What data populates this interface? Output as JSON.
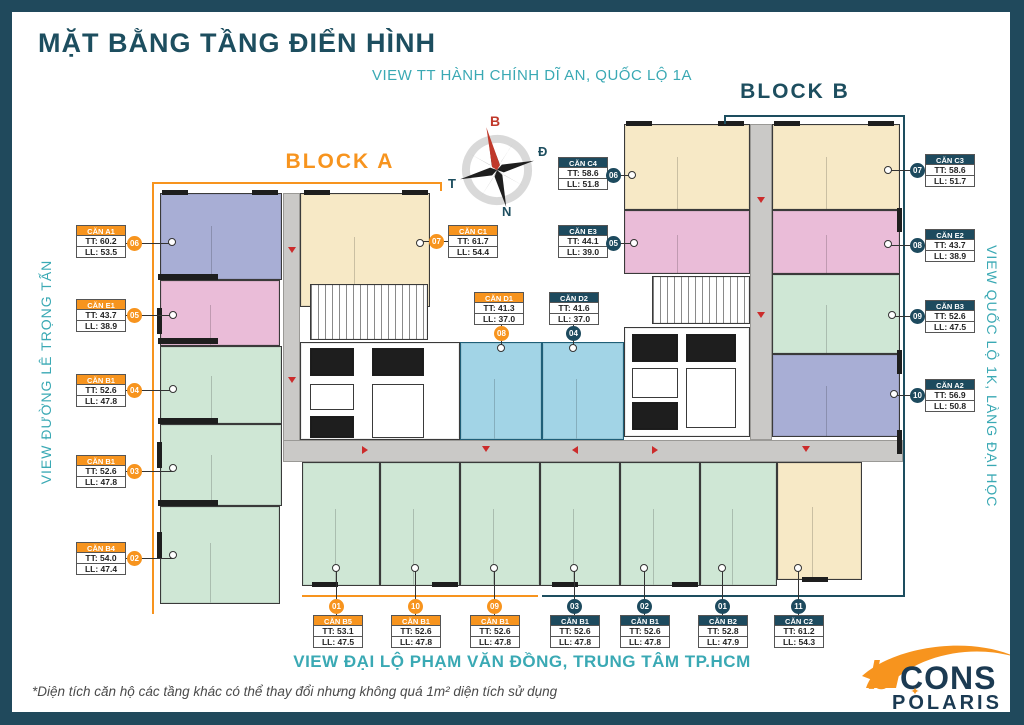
{
  "header": {
    "title": "MẶT BẰNG TẦNG ĐIỂN HÌNH",
    "subtitle": "VIEW TT HÀNH CHÍNH DĨ AN, QUỐC LỘ 1A"
  },
  "views": {
    "left": "VIEW ĐƯỜNG LÊ TRỌNG TẤN",
    "right": "VIEW QUỐC LỘ 1K, LÀNG ĐẠI HỌC",
    "bottom": "VIEW ĐẠI LỘ PHẠM VĂN ĐỒNG, TRUNG TÂM TP.HCM"
  },
  "footnote": "*Diện tích căn hộ các tầng khác có thể thay đổi nhưng không quá 1m² diện tích sử dụng",
  "blocks": {
    "a": "BLOCK A",
    "b": "BLOCK B"
  },
  "compass": {
    "north": "B",
    "east": "Đ",
    "south": "N",
    "west": "T"
  },
  "logo": {
    "b": "b",
    "cons": "CONS",
    "polaris_p": "P",
    "polaris_o": "O",
    "polaris_rest": "LARIS",
    "star": "✦"
  },
  "colors": {
    "frame": "#20495c",
    "navy": "#1d4e5f",
    "teal_text": "#3aa9b4",
    "orange": "#f7941e",
    "badge_teal": "#1d4a5e",
    "cream": "#f7e9c6",
    "pink": "#eabcd8",
    "lavender": "#a8aed5",
    "green": "#cfe7d5",
    "blue": "#a2d4e6",
    "corridor": "#cac9c7",
    "arrow_red": "#cc2b2b"
  },
  "callouts": [
    {
      "unit": "CĂN A1",
      "tt": "TT: 60.2",
      "ll": "LL: 53.5",
      "badge": "06",
      "accent": "orange",
      "label": [
        64,
        213
      ],
      "bpos": [
        122,
        231
      ],
      "dot": [
        160,
        230
      ],
      "dir": "right"
    },
    {
      "unit": "CĂN E1",
      "tt": "TT: 43.7",
      "ll": "LL: 38.9",
      "badge": "05",
      "accent": "orange",
      "label": [
        64,
        287
      ],
      "bpos": [
        122,
        303
      ],
      "dot": [
        161,
        303
      ],
      "dir": "right"
    },
    {
      "unit": "CĂN B1",
      "tt": "TT: 52.6",
      "ll": "LL: 47.8",
      "badge": "04",
      "accent": "orange",
      "label": [
        64,
        362
      ],
      "bpos": [
        122,
        378
      ],
      "dot": [
        161,
        377
      ],
      "dir": "right"
    },
    {
      "unit": "CĂN B1",
      "tt": "TT: 52.6",
      "ll": "LL: 47.8",
      "badge": "03",
      "accent": "orange",
      "label": [
        64,
        443
      ],
      "bpos": [
        122,
        459
      ],
      "dot": [
        161,
        456
      ],
      "dir": "right"
    },
    {
      "unit": "CĂN B4",
      "tt": "TT: 54.0",
      "ll": "LL: 47.4",
      "badge": "02",
      "accent": "orange",
      "label": [
        64,
        530
      ],
      "bpos": [
        122,
        546
      ],
      "dot": [
        161,
        543
      ],
      "dir": "right"
    },
    {
      "unit": "CĂN C1",
      "tt": "TT: 61.7",
      "ll": "LL: 54.4",
      "badge": "07",
      "accent": "orange",
      "label": [
        436,
        213
      ],
      "bpos": [
        424,
        229
      ],
      "dot": [
        408,
        231
      ],
      "dir": "left"
    },
    {
      "unit": "CĂN D1",
      "tt": "TT: 41.3",
      "ll": "LL: 37.0",
      "badge": "08",
      "accent": "orange",
      "label": [
        462,
        280
      ],
      "bpos": [
        489,
        321
      ],
      "dot": [
        489,
        336
      ],
      "dir": "down"
    },
    {
      "unit": "CĂN C4",
      "tt": "TT: 58.6",
      "ll": "LL: 51.8",
      "badge": "06",
      "accent": "teal",
      "label": [
        546,
        145
      ],
      "bpos": [
        601,
        163
      ],
      "dot": [
        620,
        163
      ],
      "dir": "right"
    },
    {
      "unit": "CĂN E3",
      "tt": "TT: 44.1",
      "ll": "LL: 39.0",
      "badge": "05",
      "accent": "teal",
      "label": [
        546,
        213
      ],
      "bpos": [
        601,
        231
      ],
      "dot": [
        622,
        231
      ],
      "dir": "right"
    },
    {
      "unit": "CĂN D2",
      "tt": "TT: 41.6",
      "ll": "LL: 37.0",
      "badge": "04",
      "accent": "teal",
      "label": [
        537,
        280
      ],
      "bpos": [
        561,
        321
      ],
      "dot": [
        561,
        336
      ],
      "dir": "down"
    },
    {
      "unit": "CĂN C3",
      "tt": "TT: 58.6",
      "ll": "LL: 51.7",
      "badge": "07",
      "accent": "teal",
      "label": [
        913,
        142
      ],
      "bpos": [
        905,
        158
      ],
      "dot": [
        876,
        158
      ],
      "dir": "left"
    },
    {
      "unit": "CĂN E2",
      "tt": "TT: 43.7",
      "ll": "LL: 38.9",
      "badge": "08",
      "accent": "teal",
      "label": [
        913,
        217
      ],
      "bpos": [
        905,
        233
      ],
      "dot": [
        876,
        232
      ],
      "dir": "left"
    },
    {
      "unit": "CĂN B3",
      "tt": "TT: 52.6",
      "ll": "LL: 47.5",
      "badge": "09",
      "accent": "teal",
      "label": [
        913,
        288
      ],
      "bpos": [
        905,
        304
      ],
      "dot": [
        880,
        303
      ],
      "dir": "left"
    },
    {
      "unit": "CĂN A2",
      "tt": "TT: 56.9",
      "ll": "LL: 50.8",
      "badge": "10",
      "accent": "teal",
      "label": [
        913,
        367
      ],
      "bpos": [
        905,
        383
      ],
      "dot": [
        882,
        382
      ],
      "dir": "left"
    },
    {
      "unit": "CĂN B5",
      "tt": "TT: 53.1",
      "ll": "LL: 47.5",
      "badge": "01",
      "accent": "orange",
      "label": [
        301,
        603
      ],
      "bpos": [
        324,
        594
      ],
      "dot": [
        324,
        556
      ],
      "dir": "up"
    },
    {
      "unit": "CĂN B1",
      "tt": "TT: 52.6",
      "ll": "LL: 47.8",
      "badge": "10",
      "accent": "orange",
      "label": [
        379,
        603
      ],
      "bpos": [
        403,
        594
      ],
      "dot": [
        403,
        556
      ],
      "dir": "up"
    },
    {
      "unit": "CĂN B1",
      "tt": "TT: 52.6",
      "ll": "LL: 47.8",
      "badge": "09",
      "accent": "orange",
      "label": [
        458,
        603
      ],
      "bpos": [
        482,
        594
      ],
      "dot": [
        482,
        556
      ],
      "dir": "up"
    },
    {
      "unit": "CĂN B1",
      "tt": "TT: 52.6",
      "ll": "LL: 47.8",
      "badge": "03",
      "accent": "teal",
      "label": [
        538,
        603
      ],
      "bpos": [
        562,
        594
      ],
      "dot": [
        562,
        556
      ],
      "dir": "up"
    },
    {
      "unit": "CĂN B1",
      "tt": "TT: 52.6",
      "ll": "LL: 47.8",
      "badge": "02",
      "accent": "teal",
      "label": [
        608,
        603
      ],
      "bpos": [
        632,
        594
      ],
      "dot": [
        632,
        556
      ],
      "dir": "up"
    },
    {
      "unit": "CĂN B2",
      "tt": "TT: 52.8",
      "ll": "LL: 47.9",
      "badge": "01",
      "accent": "teal",
      "label": [
        686,
        603
      ],
      "bpos": [
        710,
        594
      ],
      "dot": [
        710,
        556
      ],
      "dir": "up"
    },
    {
      "unit": "CĂN C2",
      "tt": "TT: 61.2",
      "ll": "LL: 54.3",
      "badge": "11",
      "accent": "teal",
      "label": [
        762,
        603
      ],
      "bpos": [
        786,
        594
      ],
      "dot": [
        786,
        556
      ],
      "dir": "up"
    }
  ],
  "plan": {
    "units": [
      {
        "n": "unit-a1",
        "c": "lav",
        "inner": true,
        "r": [
          148,
          181,
          122,
          87
        ]
      },
      {
        "n": "unit-c1",
        "c": "cream",
        "inner": true,
        "r": [
          288,
          181,
          130,
          114
        ]
      },
      {
        "n": "unit-e1",
        "c": "pink",
        "inner": true,
        "r": [
          148,
          268,
          120,
          66
        ]
      },
      {
        "n": "unit-b1-04",
        "c": "green",
        "inner": true,
        "r": [
          148,
          334,
          122,
          78
        ]
      },
      {
        "n": "unit-b1-03",
        "c": "green",
        "inner": true,
        "r": [
          148,
          412,
          122,
          82
        ]
      },
      {
        "n": "unit-b4",
        "c": "green",
        "inner": true,
        "r": [
          148,
          494,
          120,
          98
        ]
      },
      {
        "n": "corridor-a",
        "c": "gray",
        "r": [
          271,
          181,
          17,
          249
        ]
      },
      {
        "n": "stair-a",
        "c": "stair",
        "r": [
          298,
          272,
          118,
          56
        ]
      },
      {
        "n": "core-a",
        "c": "white",
        "r": [
          288,
          330,
          160,
          98
        ]
      },
      {
        "n": "lift-a1",
        "c": "black",
        "r": [
          298,
          336,
          44,
          28
        ]
      },
      {
        "n": "lift-a2",
        "c": "black",
        "r": [
          360,
          336,
          52,
          28
        ]
      },
      {
        "n": "lift-a3",
        "c": "out",
        "r": [
          298,
          372,
          44,
          26
        ]
      },
      {
        "n": "lift-a4",
        "c": "black",
        "r": [
          298,
          404,
          44,
          22
        ]
      },
      {
        "n": "lift-a5",
        "c": "out",
        "r": [
          360,
          372,
          52,
          54
        ]
      },
      {
        "n": "unit-d1",
        "c": "blue",
        "inner": true,
        "r": [
          448,
          330,
          82,
          98
        ]
      },
      {
        "n": "unit-d2",
        "c": "blue",
        "inner": true,
        "r": [
          530,
          330,
          82,
          98
        ]
      },
      {
        "n": "corridor-main",
        "c": "gray",
        "r": [
          271,
          428,
          620,
          22
        ]
      },
      {
        "n": "unit-b5",
        "c": "green",
        "inner": true,
        "r": [
          290,
          450,
          78,
          124
        ]
      },
      {
        "n": "unit-b1-10",
        "c": "green",
        "inner": true,
        "r": [
          368,
          450,
          80,
          124
        ]
      },
      {
        "n": "unit-b1-09",
        "c": "green",
        "inner": true,
        "r": [
          448,
          450,
          80,
          124
        ]
      },
      {
        "n": "unit-b1-03b",
        "c": "green",
        "inner": true,
        "r": [
          528,
          450,
          80,
          124
        ]
      },
      {
        "n": "unit-b1-02",
        "c": "green",
        "inner": true,
        "r": [
          608,
          450,
          80,
          124
        ]
      },
      {
        "n": "unit-b2",
        "c": "green",
        "inner": true,
        "r": [
          688,
          450,
          77,
          124
        ]
      },
      {
        "n": "unit-c2",
        "c": "cream",
        "inner": true,
        "r": [
          765,
          450,
          85,
          118
        ]
      },
      {
        "n": "unit-c4",
        "c": "cream",
        "inner": true,
        "r": [
          612,
          112,
          126,
          86
        ]
      },
      {
        "n": "unit-c3",
        "c": "cream",
        "inner": true,
        "r": [
          760,
          112,
          128,
          86
        ]
      },
      {
        "n": "corridor-b",
        "c": "gray",
        "r": [
          738,
          112,
          22,
          316
        ]
      },
      {
        "n": "unit-e3",
        "c": "pink",
        "inner": true,
        "r": [
          612,
          198,
          126,
          64
        ]
      },
      {
        "n": "unit-e2",
        "c": "pink",
        "inner": true,
        "r": [
          760,
          198,
          128,
          64
        ]
      },
      {
        "n": "unit-b3",
        "c": "green",
        "inner": true,
        "r": [
          760,
          262,
          128,
          80
        ]
      },
      {
        "n": "unit-a2",
        "c": "lav",
        "inner": true,
        "r": [
          760,
          342,
          128,
          83
        ]
      },
      {
        "n": "stair-b",
        "c": "stair",
        "r": [
          640,
          264,
          98,
          48
        ]
      },
      {
        "n": "core-b",
        "c": "white",
        "r": [
          612,
          315,
          126,
          110
        ]
      },
      {
        "n": "lift-b1",
        "c": "black",
        "r": [
          620,
          322,
          46,
          28
        ]
      },
      {
        "n": "lift-b2",
        "c": "black",
        "r": [
          674,
          322,
          50,
          28
        ]
      },
      {
        "n": "lift-b3",
        "c": "out",
        "r": [
          620,
          356,
          46,
          30
        ]
      },
      {
        "n": "lift-b4",
        "c": "black",
        "r": [
          620,
          390,
          46,
          28
        ]
      },
      {
        "n": "lift-b5",
        "c": "out",
        "r": [
          674,
          356,
          50,
          60
        ]
      }
    ],
    "wall_segments": [
      [
        150,
        178,
        26,
        5
      ],
      [
        240,
        178,
        26,
        5
      ],
      [
        292,
        178,
        26,
        5
      ],
      [
        390,
        178,
        26,
        5
      ],
      [
        145,
        296,
        5,
        26
      ],
      [
        145,
        430,
        5,
        26
      ],
      [
        145,
        520,
        5,
        26
      ],
      [
        614,
        109,
        26,
        5
      ],
      [
        706,
        109,
        26,
        5
      ],
      [
        762,
        109,
        26,
        5
      ],
      [
        856,
        109,
        26,
        5
      ],
      [
        885,
        196,
        5,
        24
      ],
      [
        885,
        338,
        5,
        24
      ],
      [
        885,
        418,
        5,
        24
      ],
      [
        300,
        570,
        26,
        5
      ],
      [
        420,
        570,
        26,
        5
      ],
      [
        540,
        570,
        26,
        5
      ],
      [
        660,
        570,
        26,
        5
      ],
      [
        790,
        565,
        26,
        5
      ],
      [
        146,
        262,
        60,
        6
      ],
      [
        146,
        326,
        60,
        6
      ],
      [
        146,
        406,
        60,
        6
      ],
      [
        146,
        488,
        60,
        6
      ]
    ],
    "arrows": [
      [
        276,
        235,
        "down"
      ],
      [
        276,
        365,
        "down"
      ],
      [
        745,
        185,
        "down"
      ],
      [
        745,
        300,
        "down"
      ],
      [
        350,
        434,
        "right"
      ],
      [
        470,
        434,
        "down"
      ],
      [
        640,
        434,
        "right"
      ],
      [
        790,
        434,
        "down"
      ],
      [
        560,
        434,
        "left"
      ]
    ],
    "brackets": {
      "a": [
        [
          140,
          170,
          290,
          2
        ],
        [
          428,
          170,
          2,
          9
        ],
        [
          140,
          170,
          2,
          432
        ],
        [
          290,
          583,
          236,
          2
        ]
      ],
      "b": [
        [
          712,
          103,
          181,
          2
        ],
        [
          712,
          103,
          2,
          9
        ],
        [
          891,
          103,
          2,
          482
        ],
        [
          530,
          583,
          361,
          2
        ]
      ]
    }
  }
}
